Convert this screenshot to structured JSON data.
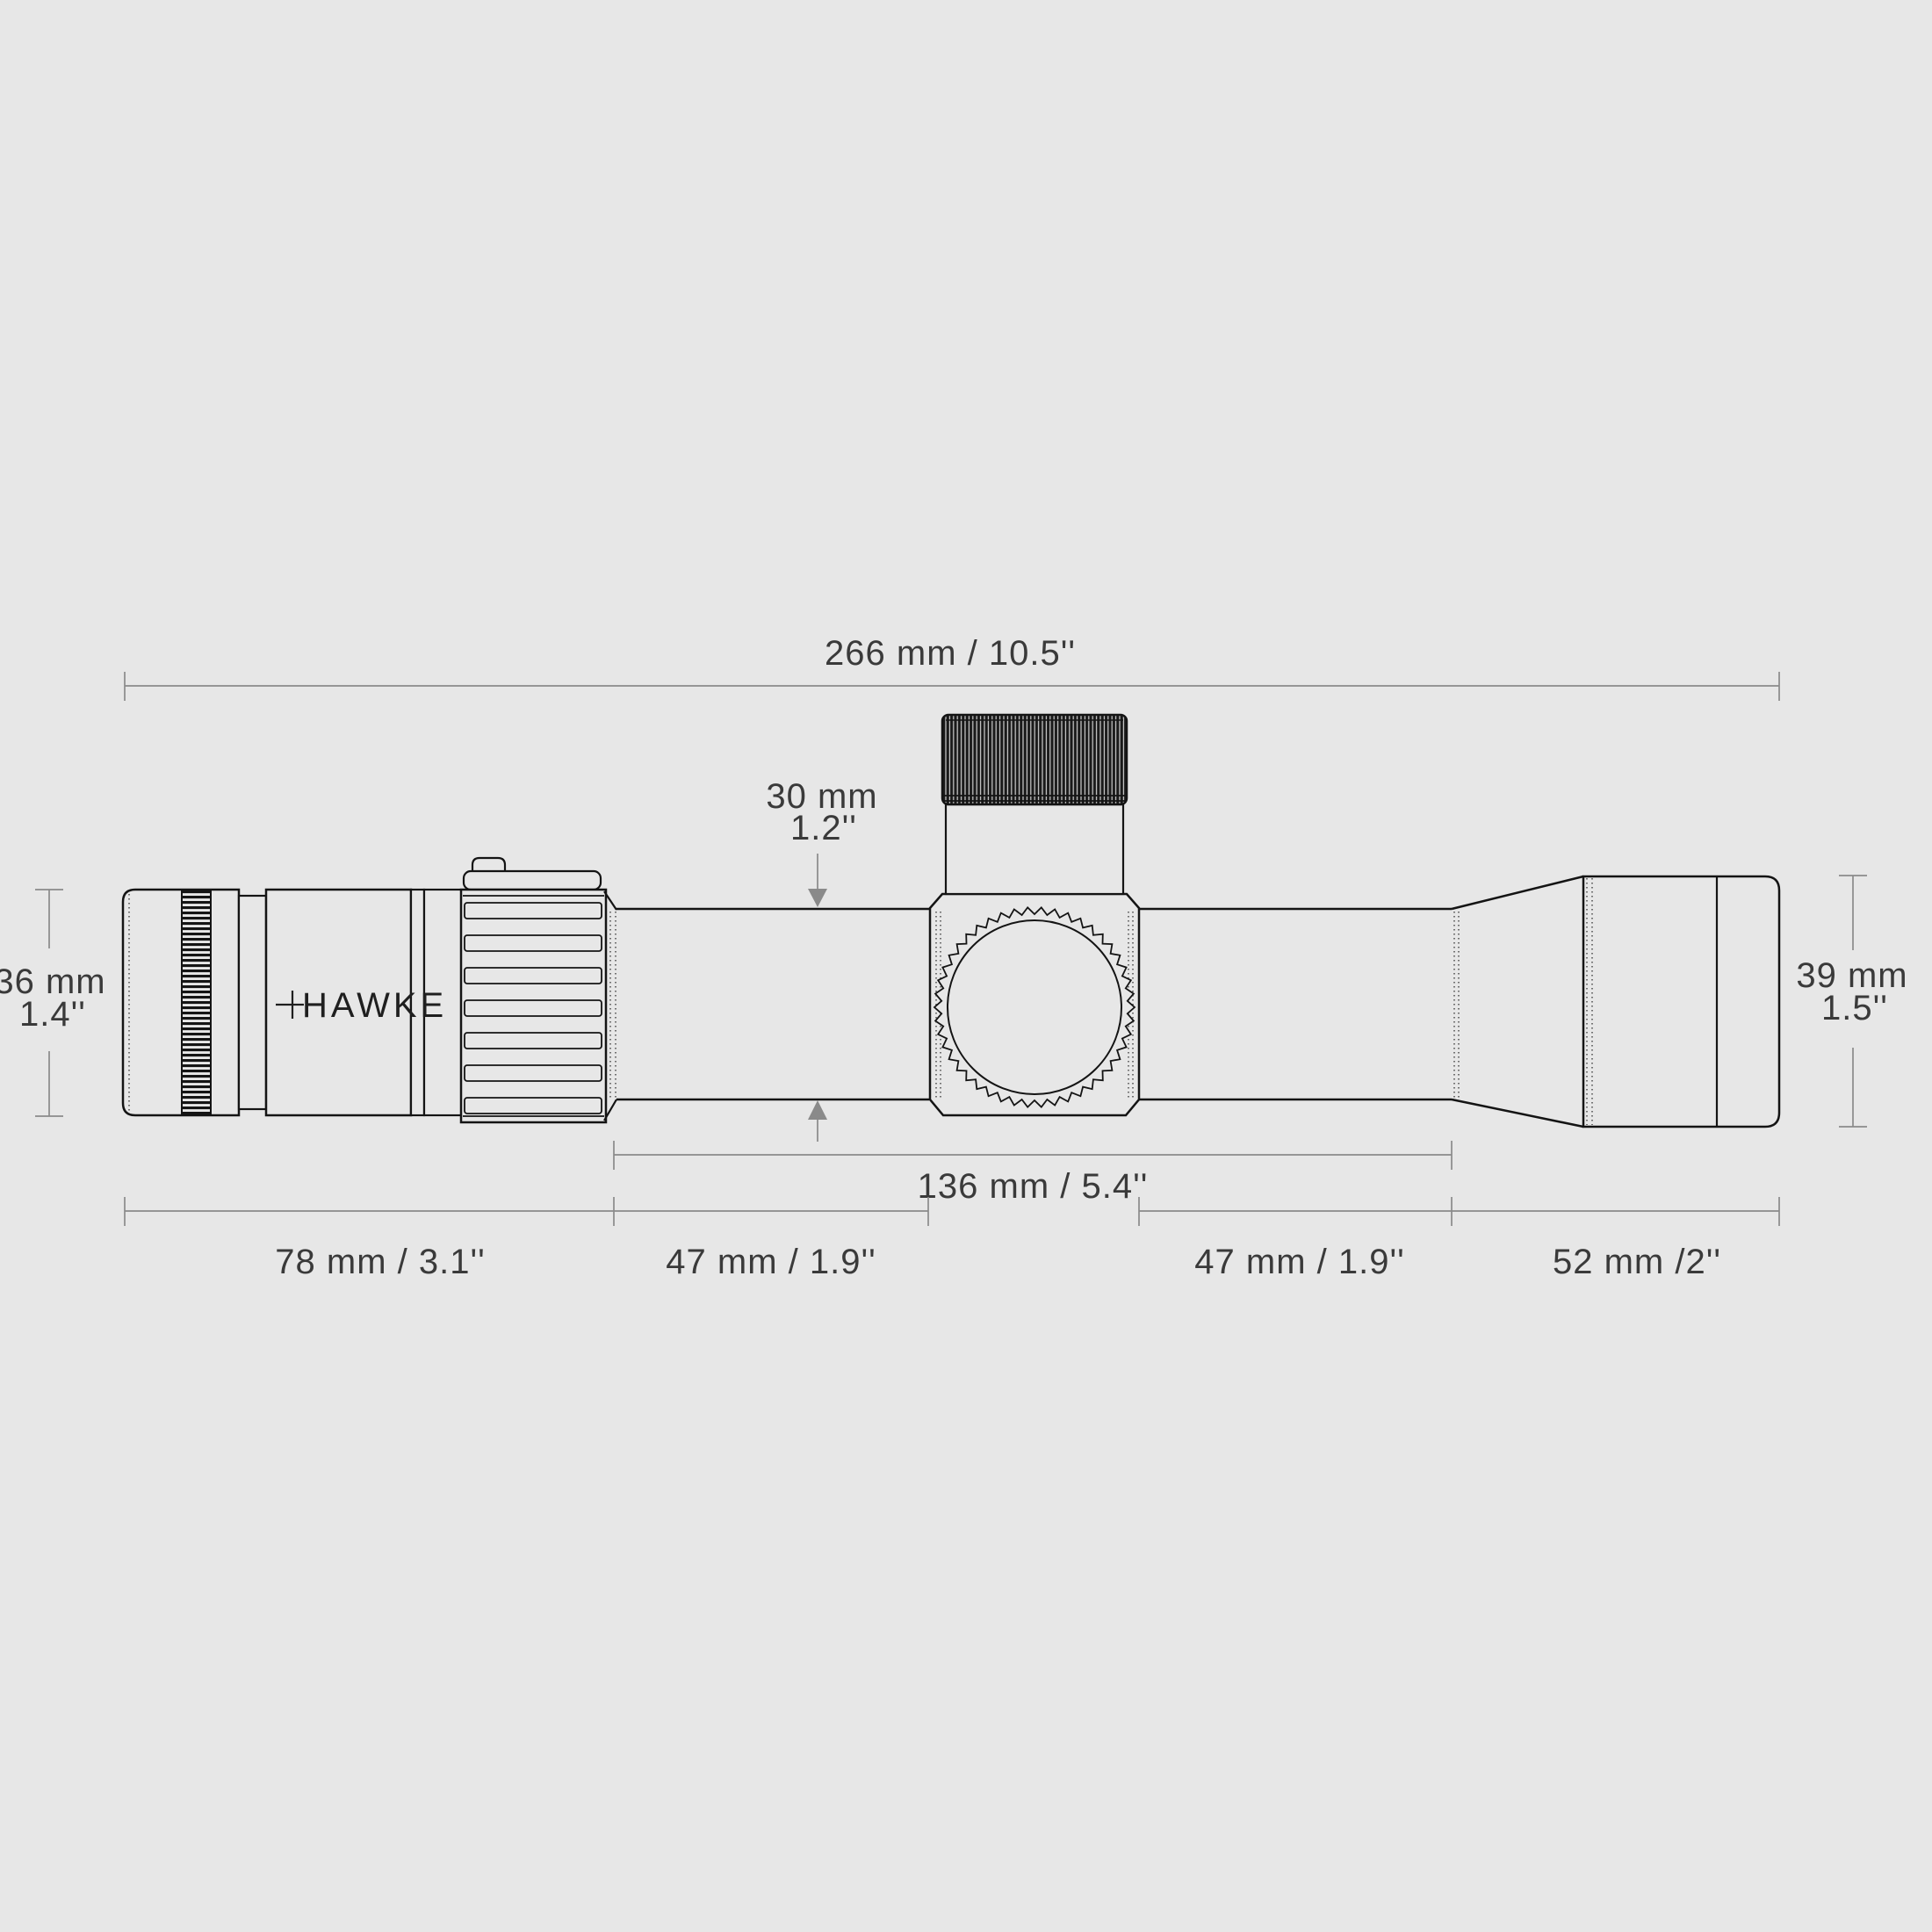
{
  "title": "Hawke riflescope technical dimensions diagram",
  "brand": {
    "logo_text": "HAWKE"
  },
  "labels": {
    "overall_length": "266 mm / 10.5''",
    "tube_diameter_mm": "30 mm",
    "tube_diameter_in": "1.2''",
    "eyepiece_diameter_mm": "36 mm",
    "eyepiece_diameter_in": "1.4''",
    "objective_diameter_mm": "39 mm",
    "objective_diameter_in": "1.5''",
    "tube_length": "136 mm / 5.4''",
    "eyepiece_length": "78 mm / 3.1''",
    "tube_rear_length": "47 mm / 1.9''",
    "tube_front_length": "47 mm / 1.9''",
    "objective_length": "52 mm /2''"
  },
  "colors": {
    "bg": "#e7e7e7",
    "outline": "#141414",
    "dim_line": "#8a8a8a",
    "ink": "#3a3a3a",
    "logo_ink": "#1f1f1f"
  }
}
